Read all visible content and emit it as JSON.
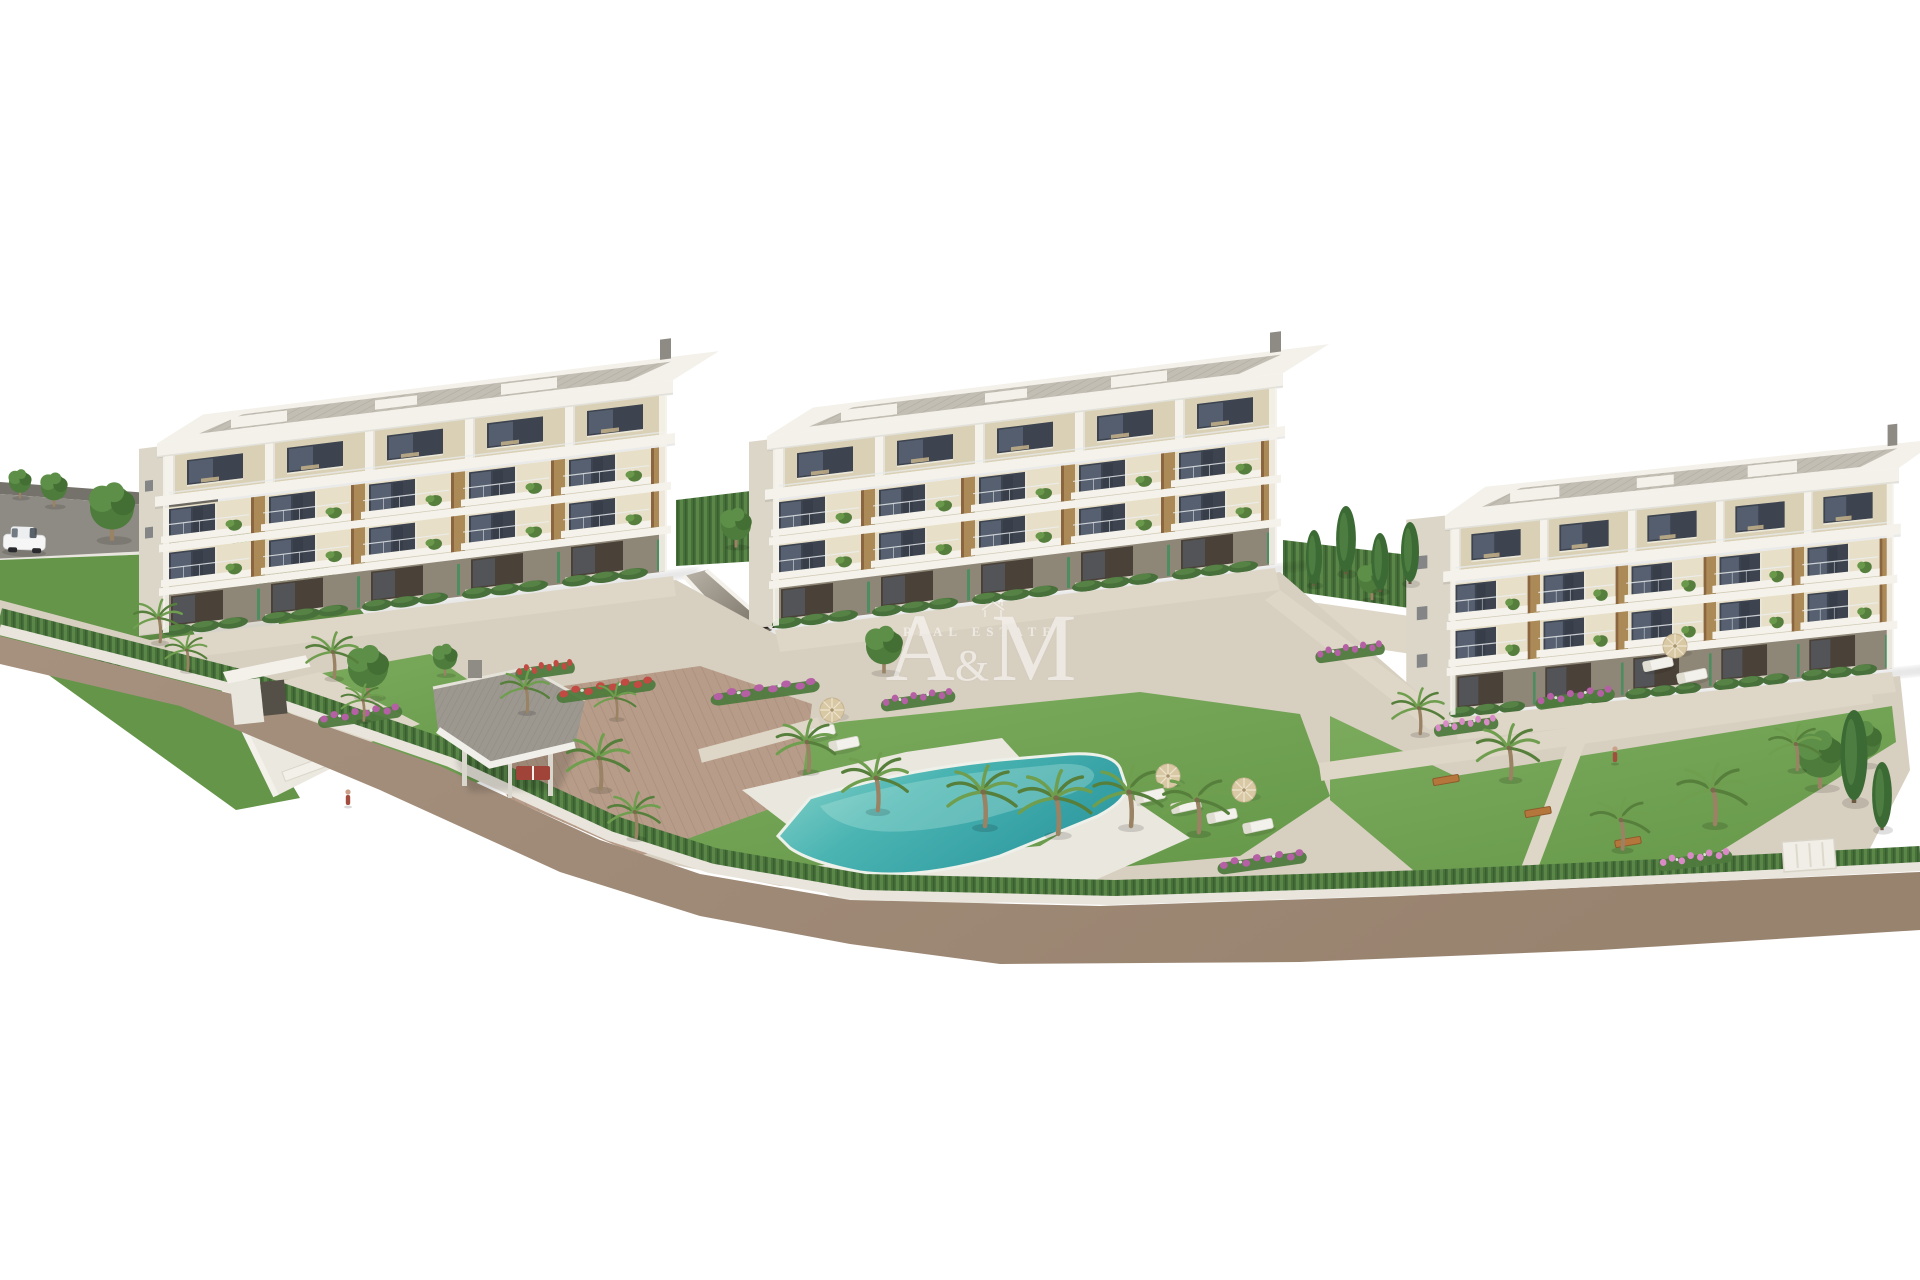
{
  "watermark": {
    "left_letter": "A",
    "ampersand": "&",
    "right_letter": "M",
    "tagline": "REAL ESTATE"
  },
  "palette": {
    "sky": "#ffffff",
    "asphalt": "#8e8b84",
    "asphalt_wall": "#75726b",
    "road": "#a3907f",
    "sidewalk": "#e9e5dc",
    "hedge_dark": "#47703a",
    "hedge_light": "#5a8748",
    "lawn": "#74a556",
    "lawn_dark": "#649549",
    "paving": "#d7cfc0",
    "paving_light": "#ded6c6",
    "terracotta": "#b79d89",
    "pool_deck": "#eae7de",
    "facade_cream": "#e7dfc8",
    "facade_top": "#d9d0b5",
    "facade_white": "#f4f2ea",
    "facade_side": "#dcd6c8",
    "ground_floor": "#8e8676",
    "window_glass": "#3d4450",
    "window_pane": "#5b6576",
    "wood": "#ab8a58",
    "roof_white": "#f3f1ea",
    "trunk": "#9a8264",
    "palm_green": "#6f9e4f",
    "palm_dark": "#567f3c",
    "flower_red": "#c14a42",
    "flower_magenta": "#b55fa5",
    "flower_pink": "#d98bc5",
    "car_body": "#f6f6f6",
    "pool_deep": "#2f9aa0",
    "pool_main": "#4ab4b2",
    "pool_light": "#8fd6cd",
    "watermark": "#ffffff"
  },
  "scene": {
    "buildings": [
      {
        "id": "b1",
        "name": "building-1",
        "bays": 5,
        "floors": 4
      },
      {
        "id": "b2",
        "name": "building-2",
        "bays": 5,
        "floors": 4
      },
      {
        "id": "b3",
        "name": "building-3",
        "bays": 5,
        "floors": 4
      }
    ],
    "palms": [
      [
        158,
        618,
        0.7
      ],
      [
        186,
        650,
        0.6
      ],
      [
        332,
        652,
        0.75
      ],
      [
        362,
        700,
        0.6
      ],
      [
        525,
        688,
        0.7
      ],
      [
        598,
        758,
        0.9
      ],
      [
        634,
        812,
        0.75
      ],
      [
        615,
        698,
        0.6
      ],
      [
        806,
        742,
        0.85
      ],
      [
        875,
        778,
        0.95
      ],
      [
        982,
        792,
        1.0
      ],
      [
        1055,
        798,
        1.05
      ],
      [
        1128,
        792,
        1.0
      ],
      [
        1196,
        800,
        0.95
      ],
      [
        1418,
        708,
        0.75
      ],
      [
        1508,
        748,
        0.9
      ],
      [
        1712,
        790,
        1.0
      ],
      [
        1795,
        744,
        0.75
      ],
      [
        1620,
        820,
        0.85
      ]
    ],
    "trees": [
      [
        112,
        512,
        1.1
      ],
      [
        20,
        484,
        0.55
      ],
      [
        54,
        490,
        0.65
      ],
      [
        368,
        672,
        1.0
      ],
      [
        884,
        650,
        0.9
      ],
      [
        736,
        528,
        0.75
      ],
      [
        1820,
        760,
        1.1
      ],
      [
        1864,
        744,
        0.85
      ],
      [
        1372,
        582,
        0.7
      ],
      [
        445,
        660,
        0.6
      ]
    ],
    "cypresses": [
      [
        1314,
        584,
        0.9
      ],
      [
        1346,
        572,
        1.1
      ],
      [
        1380,
        590,
        0.95
      ],
      [
        1410,
        582,
        1.0
      ],
      [
        1854,
        800,
        1.5
      ],
      [
        1882,
        828,
        1.1
      ]
    ],
    "loungers": [
      [
        820,
        732
      ],
      [
        844,
        744
      ],
      [
        1150,
        796
      ],
      [
        1186,
        806
      ],
      [
        1222,
        816
      ],
      [
        1258,
        826
      ],
      [
        1658,
        664
      ],
      [
        1692,
        676
      ]
    ],
    "umbrellas": [
      [
        832,
        710
      ],
      [
        1168,
        776
      ],
      [
        1244,
        790
      ],
      [
        1675,
        646
      ]
    ],
    "benches": [
      [
        1446,
        780
      ],
      [
        1538,
        812
      ],
      [
        1628,
        842
      ]
    ],
    "flower_beds": [
      {
        "x": 606,
        "y": 690,
        "w": 100,
        "c": "flower_red"
      },
      {
        "x": 360,
        "y": 716,
        "w": 85,
        "c": "flower_magenta"
      },
      {
        "x": 545,
        "y": 670,
        "w": 60,
        "c": "flower_red"
      },
      {
        "x": 765,
        "y": 692,
        "w": 110,
        "c": "flower_magenta"
      },
      {
        "x": 918,
        "y": 700,
        "w": 75,
        "c": "flower_magenta"
      },
      {
        "x": 1262,
        "y": 862,
        "w": 90,
        "c": "flower_magenta"
      },
      {
        "x": 1575,
        "y": 698,
        "w": 80,
        "c": "flower_magenta"
      },
      {
        "x": 1466,
        "y": 726,
        "w": 65,
        "c": "flower_pink"
      },
      {
        "x": 1695,
        "y": 860,
        "w": 75,
        "c": "flower_pink"
      },
      {
        "x": 1350,
        "y": 652,
        "w": 70,
        "c": "flower_magenta"
      }
    ],
    "figures": [
      [
        348,
        795
      ],
      [
        1615,
        752
      ]
    ],
    "car": {
      "x": 4,
      "y": 524
    }
  }
}
